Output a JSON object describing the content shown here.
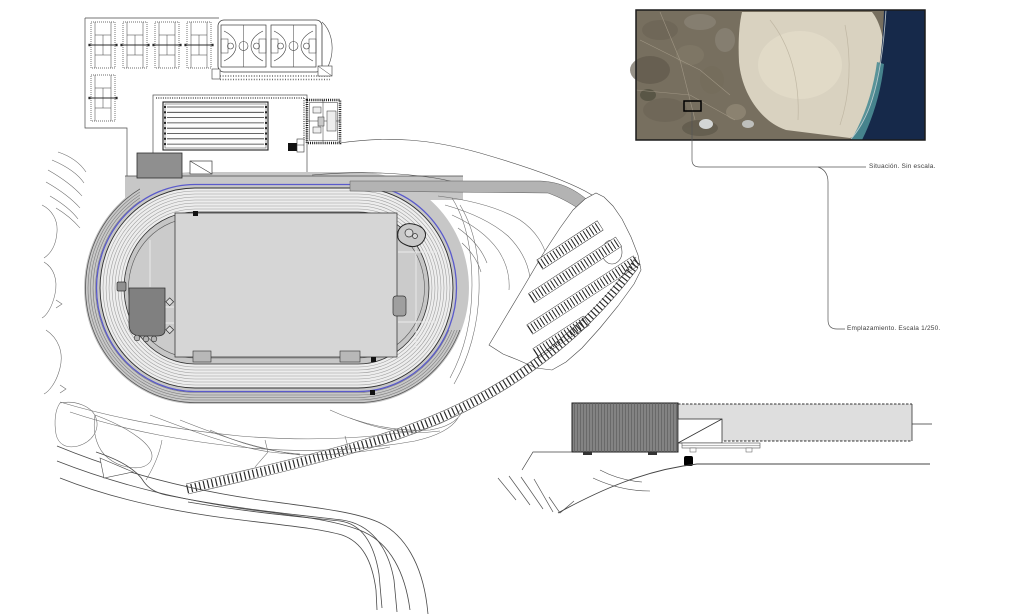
{
  "annotations": {
    "situacion": "Situación. Sin escala.",
    "emplazamiento": "Emplazamiento. Escala 1/250."
  },
  "colors": {
    "fence_blue": "#5a5acb",
    "platform_gray": "#c7c7c7",
    "track_gray": "#ededed",
    "infield_gray": "#d6d6d6",
    "building_dark": "#808080",
    "land_brown": "#776f5f",
    "dune_sand": "#d9d2c0",
    "sea_navy": "#16294a",
    "shore_teal": "#4b8d95"
  },
  "features": {
    "tennis_courts": 5,
    "basketball_courts": 2,
    "pool_lane_lines": 8,
    "track_lanes": 9,
    "parking_rows": 4
  }
}
